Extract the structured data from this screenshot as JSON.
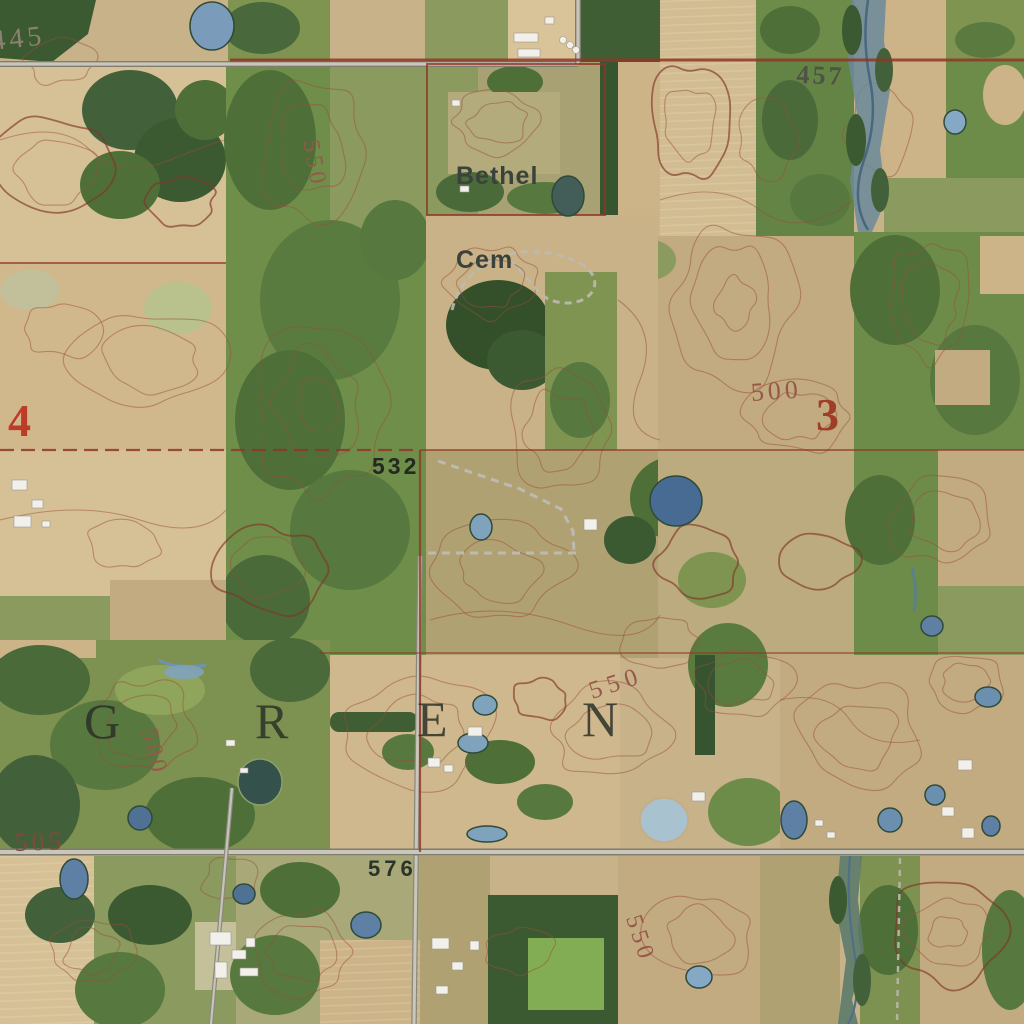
{
  "map_type": "topographic-orthoimagery",
  "township": {
    "letters": [
      "G",
      "R",
      "E",
      "N"
    ]
  },
  "section_numbers": {
    "four": "4",
    "three": "3"
  },
  "place_labels": {
    "cemetery_line1": "Bethel",
    "cemetery_line2": "Cem"
  },
  "spot_elevations": {
    "e457": "457",
    "e532": "532",
    "e576": "576"
  },
  "contour_labels": {
    "c445": "445",
    "c550_nw": "550",
    "c500_e": "500",
    "c500_sw": "500",
    "c505": "505",
    "c550_c": "550",
    "c576_note": "",
    "c550_se": "550"
  },
  "palette": {
    "contour_line": "#994a3a",
    "section_red": "#8f3627",
    "section_number_red": "#bc3d27",
    "road_gray": "#cac7ba",
    "water_blue": "#5d80a4",
    "forest_green": "#3c5a31",
    "field_tan": "#cdb488",
    "grass_green": "#7e9450"
  }
}
